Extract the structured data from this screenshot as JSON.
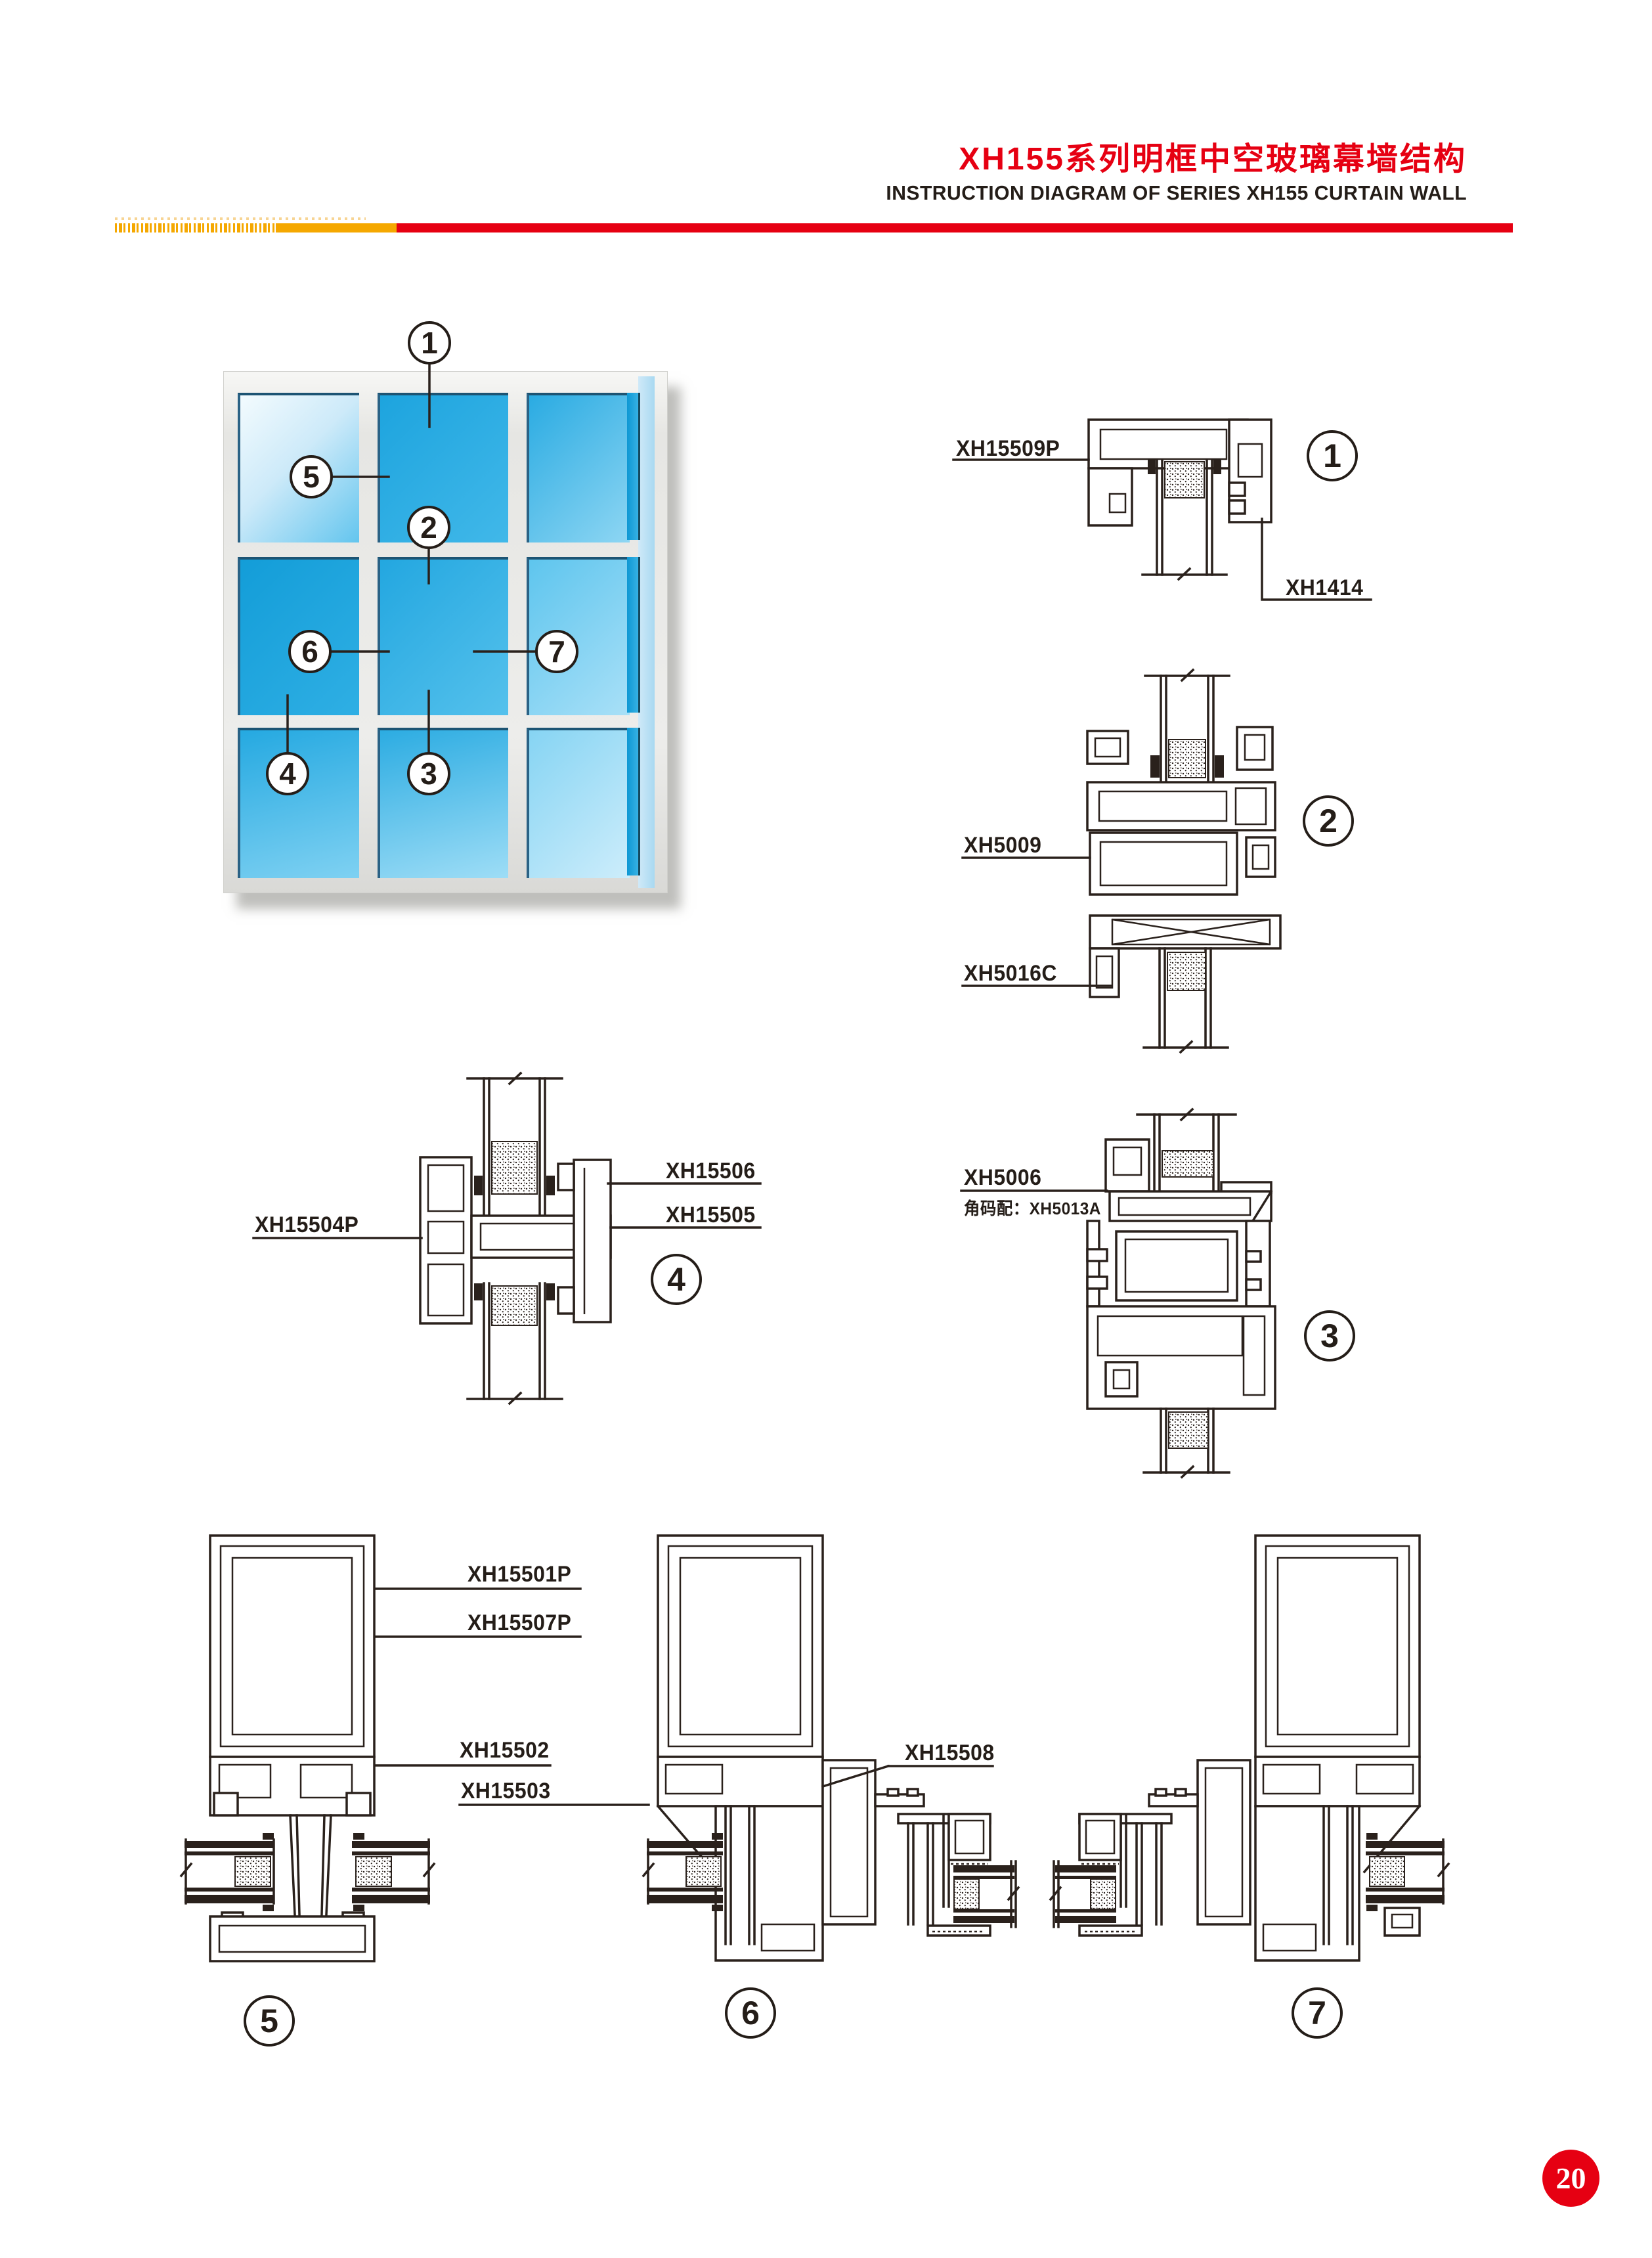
{
  "header": {
    "title_cn": "XH155系列明框中空玻璃幕墙结构",
    "title_en": "INSTRUCTION DIAGRAM OF SERIES XH155 CURTAIN WALL"
  },
  "window_figure": {
    "callouts": [
      "1",
      "2",
      "3",
      "4",
      "5",
      "6",
      "7"
    ]
  },
  "details": {
    "d1": {
      "number": "1",
      "parts": {
        "p1": "XH15509P",
        "p2": "XH1414"
      }
    },
    "d2": {
      "number": "2",
      "parts": {
        "p1": "XH5009",
        "p2": "XH5016C"
      }
    },
    "d3": {
      "number": "3",
      "parts": {
        "p1": "XH5006",
        "note": "角码配：XH5013A"
      }
    },
    "d4": {
      "number": "4",
      "parts": {
        "p1": "XH15506",
        "p2": "XH15505",
        "p3": "XH15504P"
      }
    },
    "d5": {
      "number": "5",
      "parts": {
        "p1": "XH15501P",
        "p2": "XH15507P",
        "p3": "XH15502",
        "p4": "XH15503"
      }
    },
    "d6": {
      "number": "6",
      "parts": {
        "p1": "XH15508"
      }
    },
    "d7": {
      "number": "7"
    }
  },
  "page_number": "20",
  "colors": {
    "accent_red": "#e60012",
    "accent_orange": "#f5a800",
    "line": "#2a211c",
    "glass_blue": "#29a9e1"
  }
}
